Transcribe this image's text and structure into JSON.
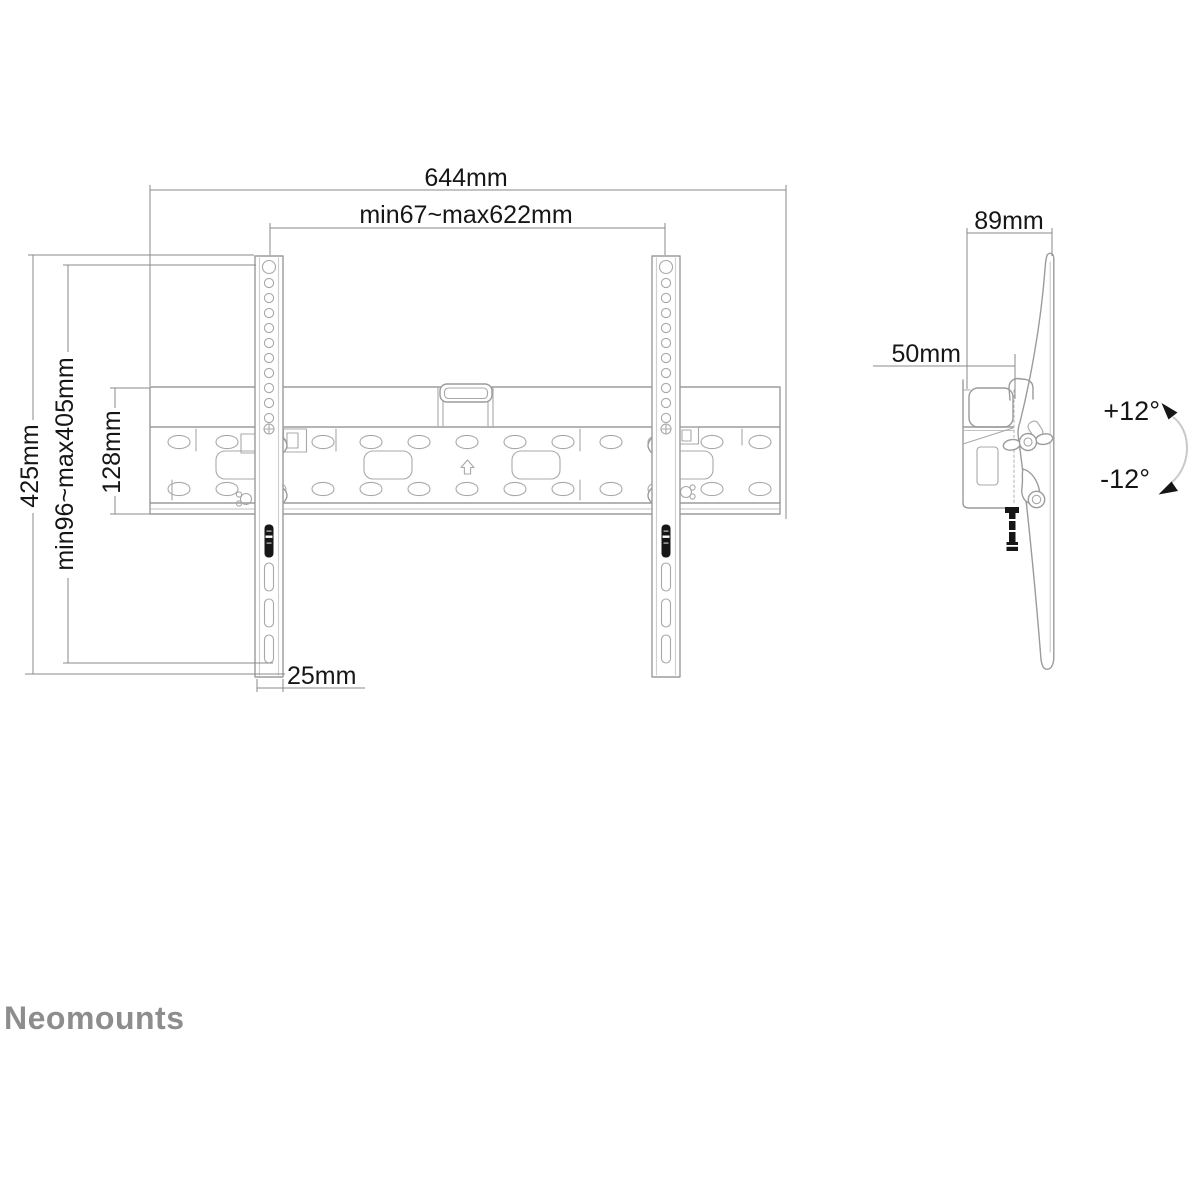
{
  "front_view": {
    "width_total": "644mm",
    "width_range": "min67~max622mm",
    "height_total": "425mm",
    "height_range": "min96~max405mm",
    "rail_height": "128mm",
    "strip_width": "25mm"
  },
  "side_view": {
    "depth": "89mm",
    "offset": "50mm",
    "tilt_up": "+12°",
    "tilt_down": "-12°"
  },
  "brand": {
    "logo": "Neomounts"
  },
  "colors": {
    "background": "#ffffff",
    "line": "#9b9b9b",
    "detail_line": "#a8a8a8",
    "dimension_line": "#8a8a8a",
    "text": "#161616",
    "logo": "#8d8d8d",
    "tilt_arc": "#c9c9c9",
    "black_fill": "#161616"
  }
}
